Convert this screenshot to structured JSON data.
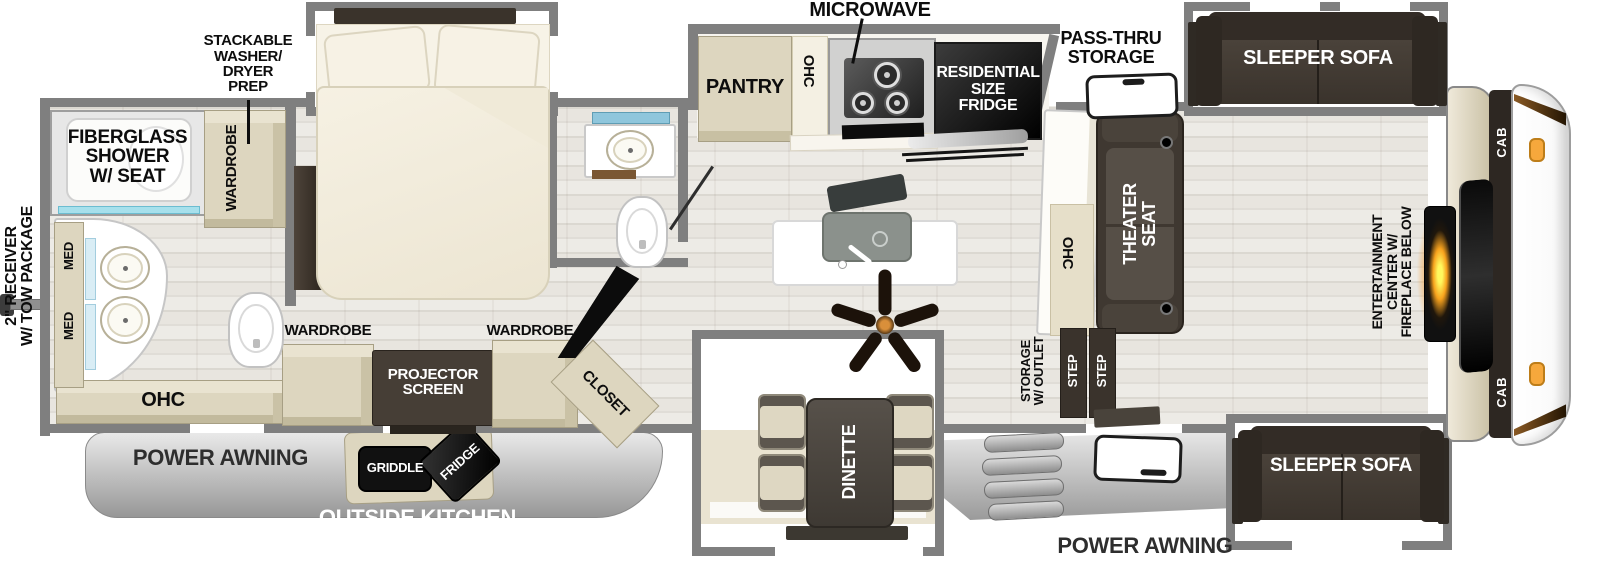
{
  "title_note": "RV fifth-wheel floorplan diagram",
  "colors": {
    "wall_gray": "#7f7f7f",
    "cabinet_beige": "#ddd6bf",
    "furniture_dark": "#463e36",
    "floor_light": "#e8e5df",
    "shower_glass_teal": "#a7e0ec",
    "shelf_blue": "#8fc6dc",
    "fireplace_glow": "#f7941d",
    "marker_light_orange": "#f6a83c",
    "awning_gray": "#b5b5b5"
  },
  "labels": {
    "receiver": "2\" RECEIVER\nW/ TOW PACKAGE",
    "fiberglass_shower": "FIBERGLASS\nSHOWER\nW/ SEAT",
    "washer_dryer_prep": "STACKABLE\nWASHER/\nDRYER\nPREP",
    "wardrobe": "WARDROBE",
    "med": "MED",
    "ohc": "OHC",
    "microwave": "MICROWAVE",
    "pantry": "PANTRY",
    "residential_fridge": "RESIDENTIAL\nSIZE\nFRIDGE",
    "pass_thru": "PASS-THRU\nSTORAGE",
    "sleeper_sofa": "SLEEPER SOFA",
    "cab": "CAB",
    "entertainment": "ENTERTAINMENT\nCENTER W/\nFIREPLACE BELOW",
    "theater_seat": "THEATER\nSEAT",
    "storage_outlet": "STORAGE\nW/ OUTLET",
    "step": "STEP",
    "dinette": "DINETTE",
    "projector": "PROJECTOR\nSCREEN",
    "closet": "CLOSET",
    "griddle": "GRIDDLE",
    "fridge": "FRIDGE",
    "power_awning": "POWER AWNING",
    "outside_kitchen": "OUTSIDE KITCHEN"
  }
}
